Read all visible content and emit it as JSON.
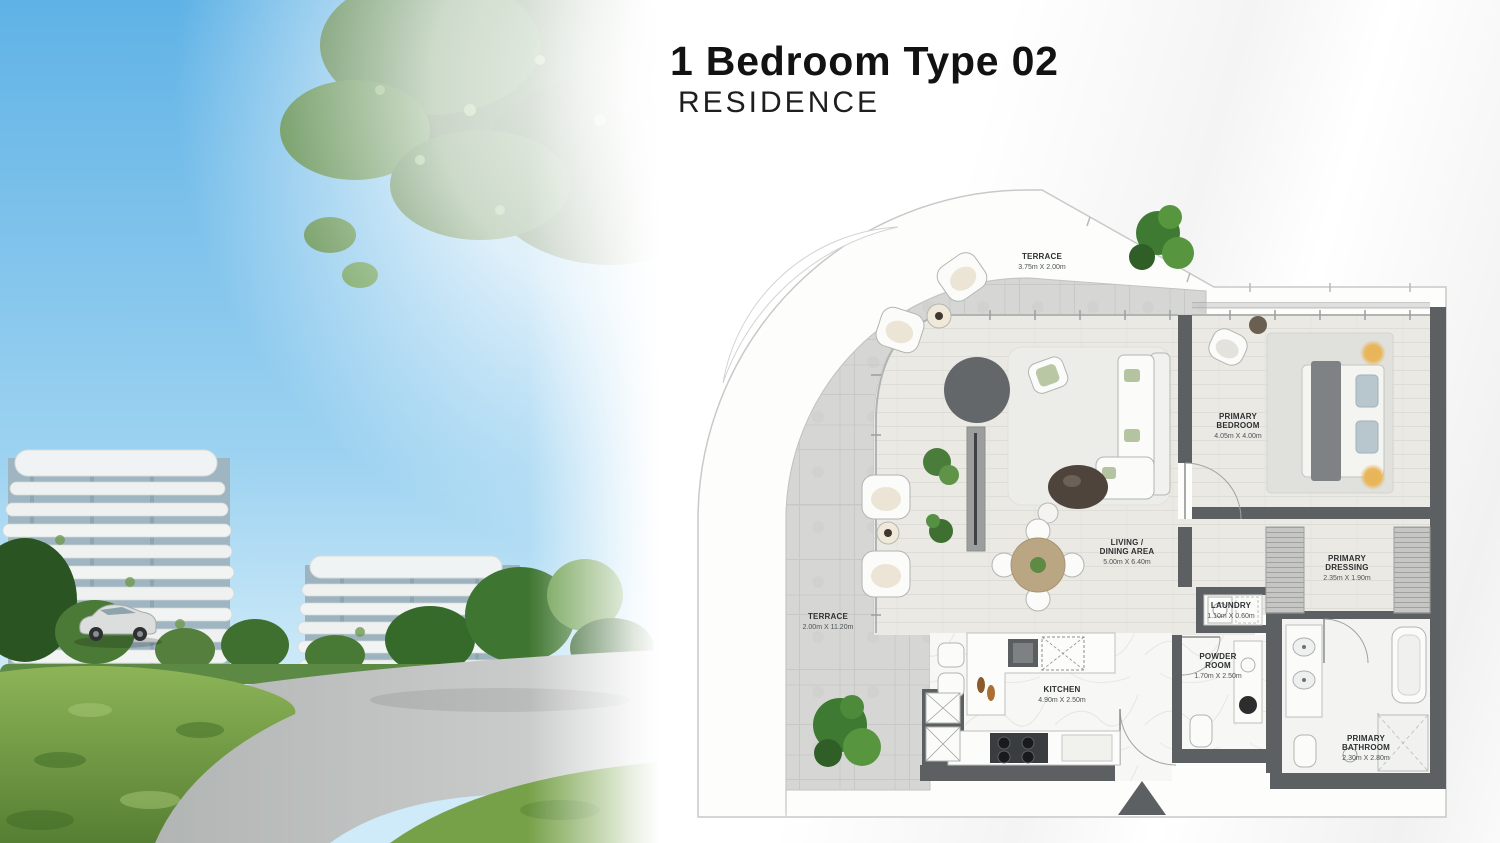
{
  "header": {
    "title": "1 Bedroom Type 02",
    "subtitle": "RESIDENCE"
  },
  "floor_plan": {
    "rooms": {
      "terrace_top": {
        "name": "TERRACE",
        "dims": "3.75m X 2.00m"
      },
      "terrace_side": {
        "name": "TERRACE",
        "dims": "2.00m X 11.20m"
      },
      "living_dining": {
        "name_line1": "LIVING /",
        "name_line2": "DINING AREA",
        "dims": "5.00m X 6.40m"
      },
      "primary_bedroom": {
        "name_line1": "PRIMARY",
        "name_line2": "BEDROOM",
        "dims": "4.05m X 4.00m"
      },
      "primary_dressing": {
        "name_line1": "PRIMARY",
        "name_line2": "DRESSING",
        "dims": "2.35m X 1.90m"
      },
      "laundry": {
        "name": "LAUNDRY",
        "dims": "1.10m X 0.60m"
      },
      "powder_room": {
        "name_line1": "POWDER",
        "name_line2": "ROOM",
        "dims": "1.70m X 2.50m"
      },
      "kitchen": {
        "name": "KITCHEN",
        "dims": "4.90m X 2.50m"
      },
      "primary_bathroom": {
        "name_line1": "PRIMARY",
        "name_line2": "BATHROOM",
        "dims": "2.30m X 2.80m"
      }
    },
    "colors": {
      "wall": "#5c6063",
      "terrace_floor": "#d6d7d5",
      "wood_floor": "#eae9e4",
      "marble_floor": "#f7f7f5",
      "plant_green": "#4f8a3d",
      "lamp_glow": "#e8b558"
    }
  }
}
